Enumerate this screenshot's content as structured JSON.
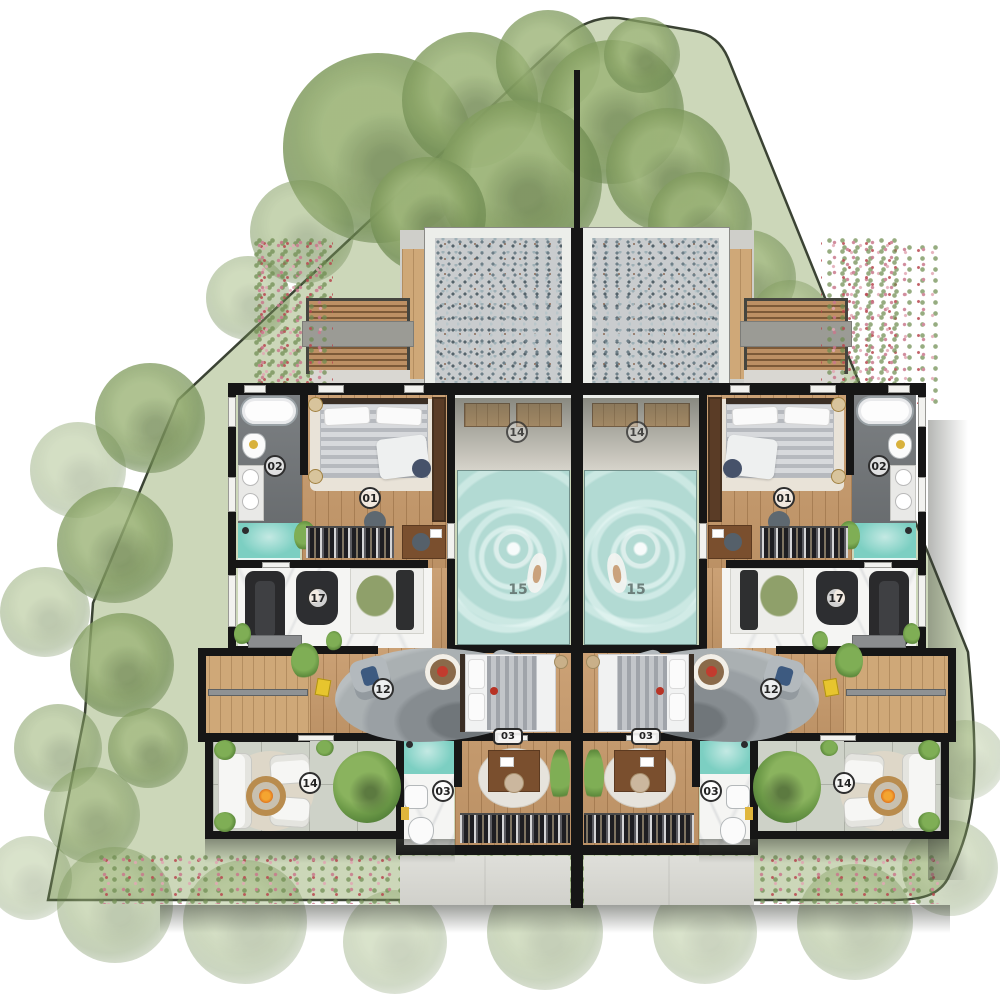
{
  "plan": {
    "room_labels": {
      "bedroom_master": "01",
      "bathroom_master": "02",
      "bedroom_guest": "03",
      "bathroom_guest": "03",
      "living": "12",
      "terrace": "14",
      "pool_deck": "14",
      "pool": "15",
      "gym": "17"
    },
    "colors": {
      "grass": "#ccd7b9",
      "boundary": "#3b4334",
      "wall": "#161616",
      "wood_floor": "#c79a6b",
      "pool_water": "#b2dad3",
      "shower_teal": "#7ccfc2",
      "marble": "#f5f5f3",
      "bath_floor": "#75797c",
      "pebble_court": "#c9ccce",
      "terrace_stone": "#ced2c8",
      "concrete": "#d9d9d3"
    }
  }
}
